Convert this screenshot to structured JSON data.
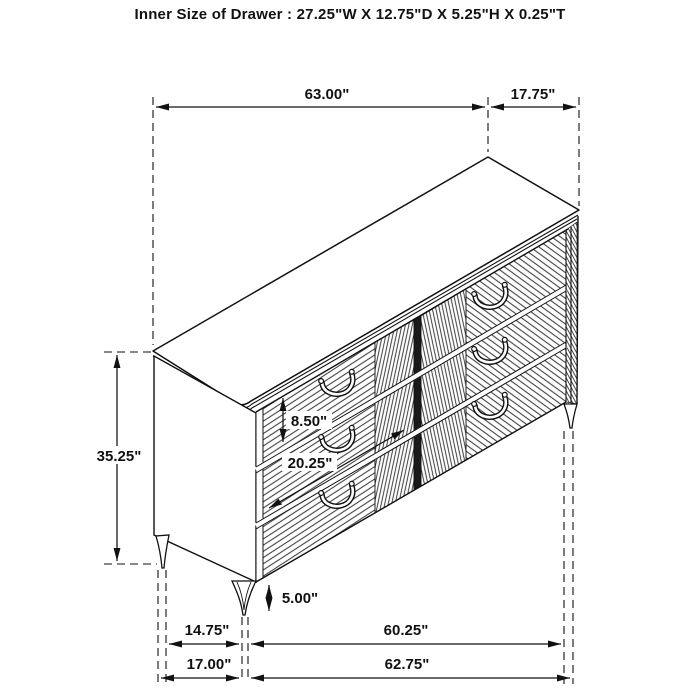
{
  "title": "Inner Size of Drawer : 27.25\"W X 12.75\"D X 5.25\"H X 0.25\"T",
  "drawing": {
    "subject": "six-drawer dresser",
    "view": "isometric line drawing with dimensions",
    "line_color": "#111111",
    "background": "#ffffff"
  },
  "dimensions": {
    "top_width": "63.00\"",
    "top_depth": "17.75\"",
    "body_height": "35.25\"",
    "drawer_front_height": "8.50\"",
    "drawer_front_width": "20.25\"",
    "leg_height": "5.00\"",
    "base_side_inset": "14.75\"",
    "leg_span_width": "60.25\"",
    "base_depth": "17.00\"",
    "base_width": "62.75\""
  }
}
